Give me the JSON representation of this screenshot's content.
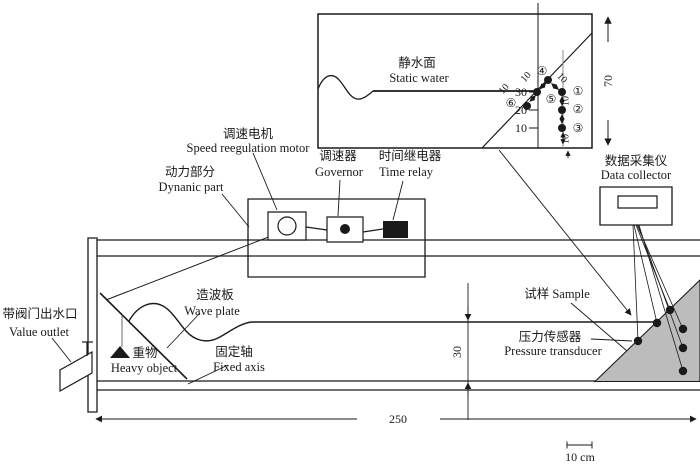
{
  "figure": {
    "inset": {
      "static_water": {
        "zh": "静水面",
        "en": "Static water"
      },
      "ticks": [
        "30",
        "20",
        "10"
      ],
      "dim_70": "70",
      "dim_10": "10",
      "points": {
        "p1": "①",
        "p2": "②",
        "p3": "③",
        "p4": "④",
        "p5": "⑤",
        "p6": "⑥"
      }
    },
    "components": {
      "dynamic_part": {
        "zh": "动力部分",
        "en": "Dynanic part"
      },
      "speed_motor": {
        "zh": "调速电机",
        "en": "Speed reegulation motor"
      },
      "governor": {
        "zh": "调速器",
        "en": "Governor"
      },
      "time_relay": {
        "zh": "时间继电器",
        "en": "Time relay"
      },
      "data_collector": {
        "zh": "数据采集仪",
        "en": "Data collector"
      },
      "valve_outlet": {
        "zh": "带阀门出水口",
        "en": "Value outlet"
      },
      "wave_plate": {
        "zh": "造波板",
        "en": "Wave plate"
      },
      "heavy_object": {
        "zh": "重物",
        "en": "Heavy object"
      },
      "fixed_axis": {
        "zh": "固定轴",
        "en": "Fixed axis"
      },
      "sample": {
        "zh_en": "试样 Sample"
      },
      "pressure_transducer": {
        "zh": "压力传感器",
        "en": "Pressure transducer"
      }
    },
    "dimensions": {
      "flume_length": "250",
      "water_depth": "30",
      "scale_bar": "10 cm"
    },
    "colors": {
      "slope_fill": "#bcbcbc",
      "line": "#1a1a1a"
    }
  }
}
